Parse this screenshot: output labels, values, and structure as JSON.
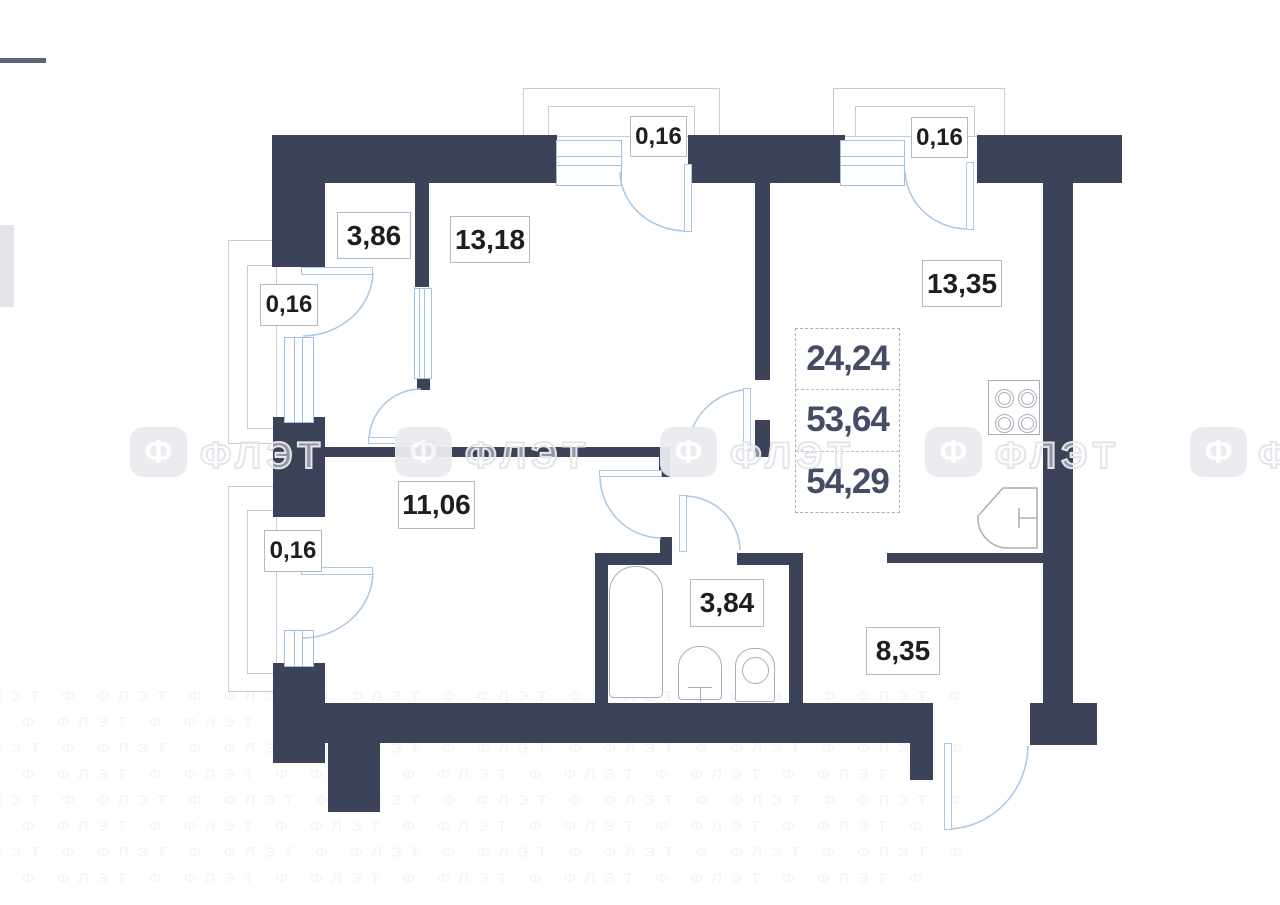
{
  "floorplan": {
    "rooms": [
      {
        "id": "hallway-top",
        "area": "3,86"
      },
      {
        "id": "bedroom",
        "area": "13,18"
      },
      {
        "id": "kitchen-living",
        "area": "13,35"
      },
      {
        "id": "room-bottom",
        "area": "11,06"
      },
      {
        "id": "bathroom",
        "area": "3,84"
      },
      {
        "id": "hall-entrance",
        "area": "8,35"
      }
    ],
    "balconies": [
      {
        "id": "balcony-top-center",
        "area": "0,16"
      },
      {
        "id": "balcony-top-right",
        "area": "0,16"
      },
      {
        "id": "balcony-left-upper",
        "area": "0,16"
      },
      {
        "id": "balcony-left-lower",
        "area": "0,16"
      }
    ],
    "summary": {
      "values": [
        "24,24",
        "53,64",
        "54,29"
      ]
    },
    "watermark": {
      "logo_glyph": "Ф",
      "text": "ФЛЭТ",
      "faint_row": "ФЛЭТ Ф ФЛЭТ Ф ФЛЭТ Ф ФЛЭТ Ф ФЛЭТ Ф ФЛЭТ Ф ФЛЭТ Ф ФЛЭТ Ф"
    },
    "colors": {
      "wall": "#3c4258",
      "door_line": "#a9c7e6",
      "window_line": "#9fc2e2",
      "fixture_line": "#a7adb8",
      "balcony_outline": "#c8cbd2",
      "label_text": "#1d1e22",
      "summary_text": "#454c66",
      "watermark": "#e6e8ed"
    }
  }
}
